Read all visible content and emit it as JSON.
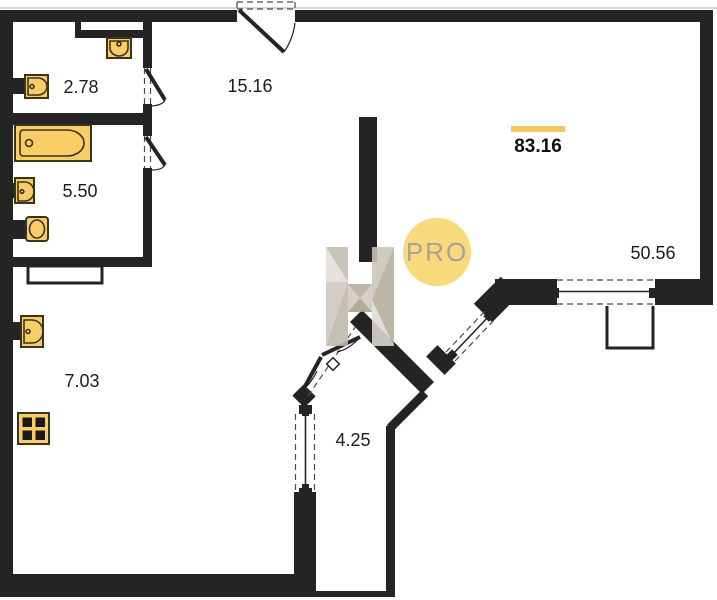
{
  "floorplan": {
    "title": "apartment-floor-plan",
    "colors": {
      "wall": "#242424",
      "fixture_fill": "#f8cd66",
      "fixture_stroke": "#3b331f",
      "highlight_bar": "#f2c761",
      "badge_bg": "#f8d97c",
      "badge_text_color": "#a8a298",
      "label_color": "#1c1c1c"
    },
    "total_area": {
      "value": "83.16"
    },
    "rooms": [
      {
        "id": "room-top-left",
        "area": "2.78"
      },
      {
        "id": "room-hall-top",
        "area": "15.16"
      },
      {
        "id": "room-bathroom",
        "area": "5.50"
      },
      {
        "id": "room-hall-left",
        "area": "7.03"
      },
      {
        "id": "room-corridor",
        "area": "4.25"
      },
      {
        "id": "room-living",
        "area": "50.56"
      }
    ],
    "watermark": {
      "badge_text": "PRO"
    }
  }
}
